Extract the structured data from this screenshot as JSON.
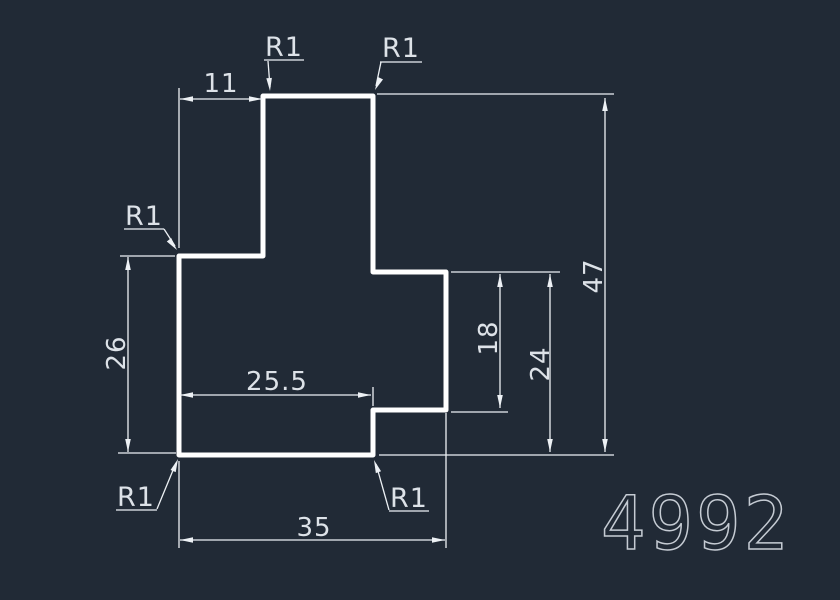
{
  "drawing": {
    "part_number": "4992",
    "type": "2D part profile with dimensions"
  },
  "colors": {
    "background": "#212a36",
    "outline": "#ffffff",
    "dim_line": "#edf1f5",
    "dim_text": "#dde2e8",
    "part_number": "#c5cbd3"
  },
  "dimensions": {
    "tab_offset": "11",
    "left_height": "26",
    "notch_offset": "25.5",
    "total_width": "35",
    "right_arm_height": "18",
    "right_height": "24",
    "total_height": "47"
  },
  "fillets": {
    "top_left": "R1",
    "top_right": "R1",
    "left_step": "R1",
    "bottom_left": "R1",
    "bottom_mid": "R1"
  },
  "geometry_units": {
    "outline_points": [
      [
        0,
        0
      ],
      [
        0,
        26
      ],
      [
        11,
        26
      ],
      [
        11,
        47
      ],
      [
        25.5,
        47
      ],
      [
        25.5,
        24
      ],
      [
        35,
        24
      ],
      [
        35,
        6
      ],
      [
        25.5,
        6
      ],
      [
        25.5,
        0
      ]
    ],
    "fillet_radius": "1"
  }
}
